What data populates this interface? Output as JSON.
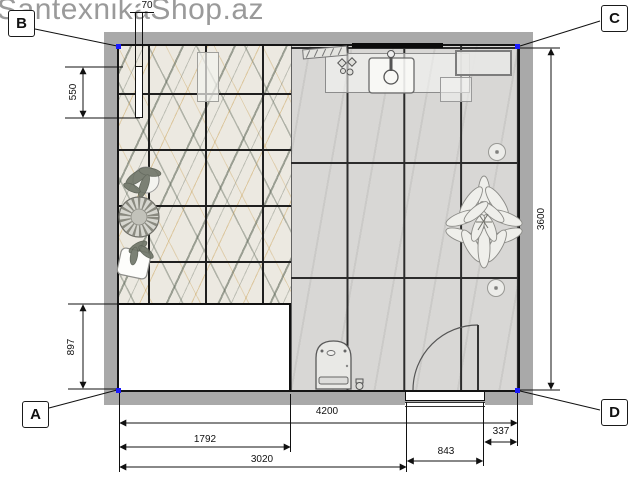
{
  "watermark": "SantexnikaShop.az",
  "corner_labels": {
    "top_left": "B",
    "top_right": "C",
    "bottom_left": "A",
    "bottom_right": "D"
  },
  "dimensions": {
    "partition_thickness": "70",
    "partition_length": "550",
    "bath_zone_depth": "897",
    "room_depth": "3600",
    "room_width": "4200",
    "shower_zone_width": "1792",
    "wall_to_door": "3020",
    "door_opening": "843",
    "door_to_corner": "337"
  },
  "colors": {
    "marker_blue": "#1a1aff",
    "wall_gray": "#a9a9a9",
    "marble_base": "#ece9e1",
    "floor_gray": "#d8d7d5",
    "annotation": "#111111"
  }
}
